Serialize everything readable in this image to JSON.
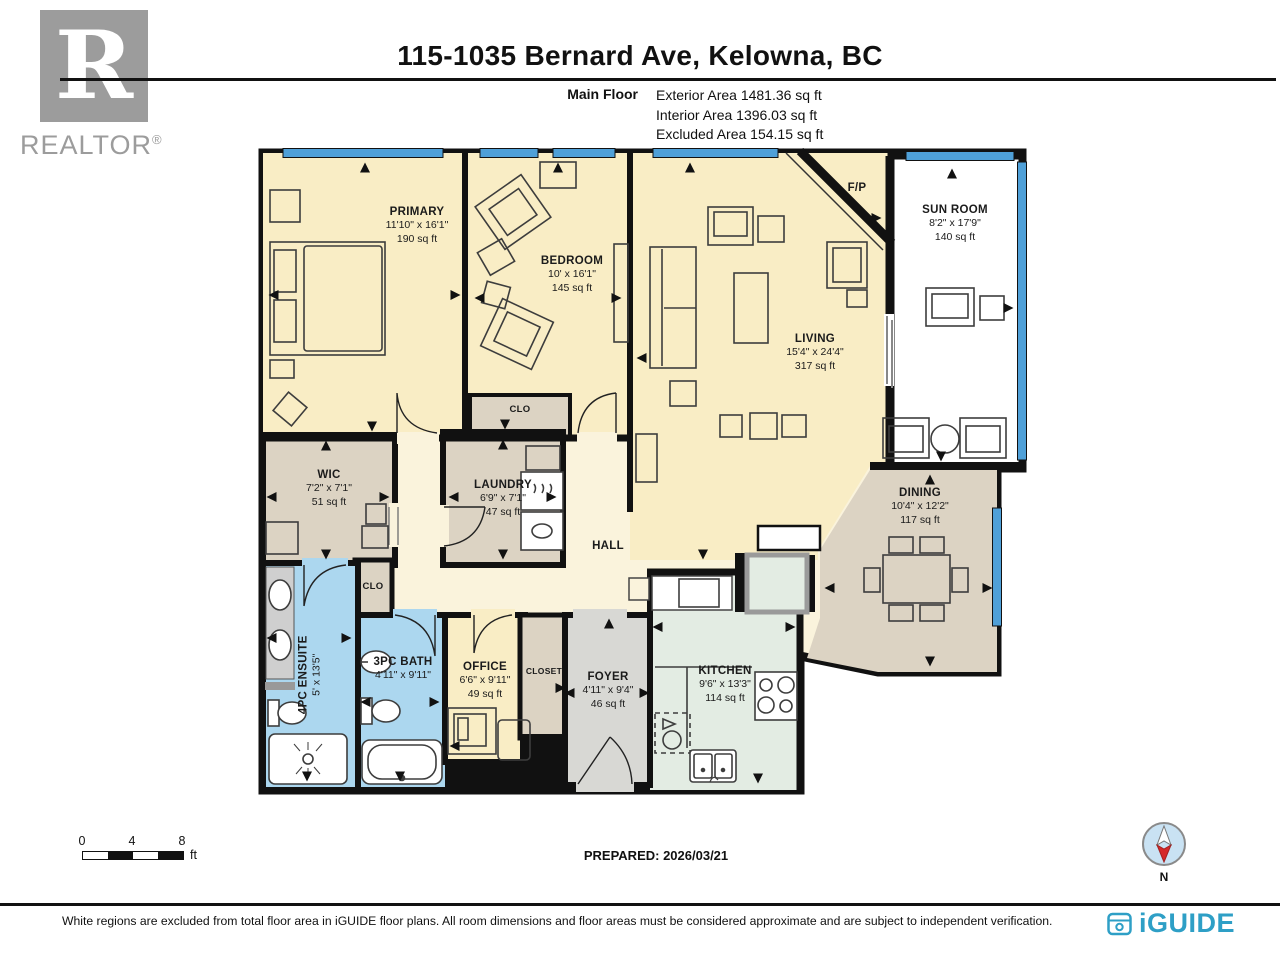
{
  "header": {
    "title": "115-1035 Bernard Ave, Kelowna, BC",
    "floor_label": "Main Floor",
    "areas": [
      "Exterior Area 1481.36 sq ft",
      "Interior Area 1396.03 sq ft",
      "Excluded Area 154.15 sq ft"
    ],
    "realtor": {
      "letter": "R",
      "wordmark": "REALTOR",
      "reg": "®"
    }
  },
  "rooms": {
    "primary": {
      "name": "PRIMARY",
      "dims": "11'10\" x 16'1\"",
      "area": "190 sq ft"
    },
    "bedroom": {
      "name": "BEDROOM",
      "dims": "10' x 16'1\"",
      "area": "145 sq ft"
    },
    "living": {
      "name": "LIVING",
      "dims": "15'4\" x 24'4\"",
      "area": "317 sq ft"
    },
    "sunroom": {
      "name": "SUN ROOM",
      "dims": "8'2\" x 17'9\"",
      "area": "140 sq ft"
    },
    "wic": {
      "name": "WIC",
      "dims": "7'2\" x 7'1\"",
      "area": "51 sq ft"
    },
    "laundry": {
      "name": "LAUNDRY",
      "dims": "6'9\" x 7'1\"",
      "area": "47 sq ft"
    },
    "dining": {
      "name": "DINING",
      "dims": "10'4\" x 12'2\"",
      "area": "117 sq ft"
    },
    "ensuite": {
      "name": "4PC ENSUITE",
      "dims": "5' x 13'5\""
    },
    "bath": {
      "name": "3PC BATH",
      "dims": "4'11\" x 9'11\""
    },
    "office": {
      "name": "OFFICE",
      "dims": "6'6\" x 9'11\"",
      "area": "49 sq ft"
    },
    "closet": {
      "name": "CLOSET"
    },
    "foyer": {
      "name": "FOYER",
      "dims": "4'11\" x 9'4\"",
      "area": "46 sq ft"
    },
    "kitchen": {
      "name": "KITCHEN",
      "dims": "9'6\" x 13'3\"",
      "area": "114 sq ft"
    },
    "hall": {
      "name": "HALL"
    },
    "clo_bedroom": {
      "name": "CLO"
    },
    "clo_hall": {
      "name": "CLO"
    },
    "fireplace": {
      "name": "F/P"
    }
  },
  "scale": {
    "ticks": [
      "0",
      "4",
      "8"
    ],
    "unit": "ft"
  },
  "footer": {
    "prepared": "PREPARED: 2026/03/21",
    "compass_label": "N",
    "disclaimer": "White regions are excluded from total floor area in iGUIDE floor plans. All room dimensions and floor areas must be considered approximate and are subject to independent verification.",
    "brand": "iGUIDE"
  },
  "colors": {
    "wall": "#111111",
    "room_cream": "#F9EDC5",
    "hall_cream": "#FAF3DC",
    "tan": "#DCD3C3",
    "bath_blue": "#ACD7EF",
    "kitchen_green": "#E3ECE3",
    "foyer_gray": "#D8D8D4",
    "sunroom_white": "#FFFFFF",
    "window_blue": "#4FA0D8",
    "brand_blue": "#2E9FC6",
    "logo_gray": "#9C9C9C",
    "compass_red": "#D62828"
  }
}
